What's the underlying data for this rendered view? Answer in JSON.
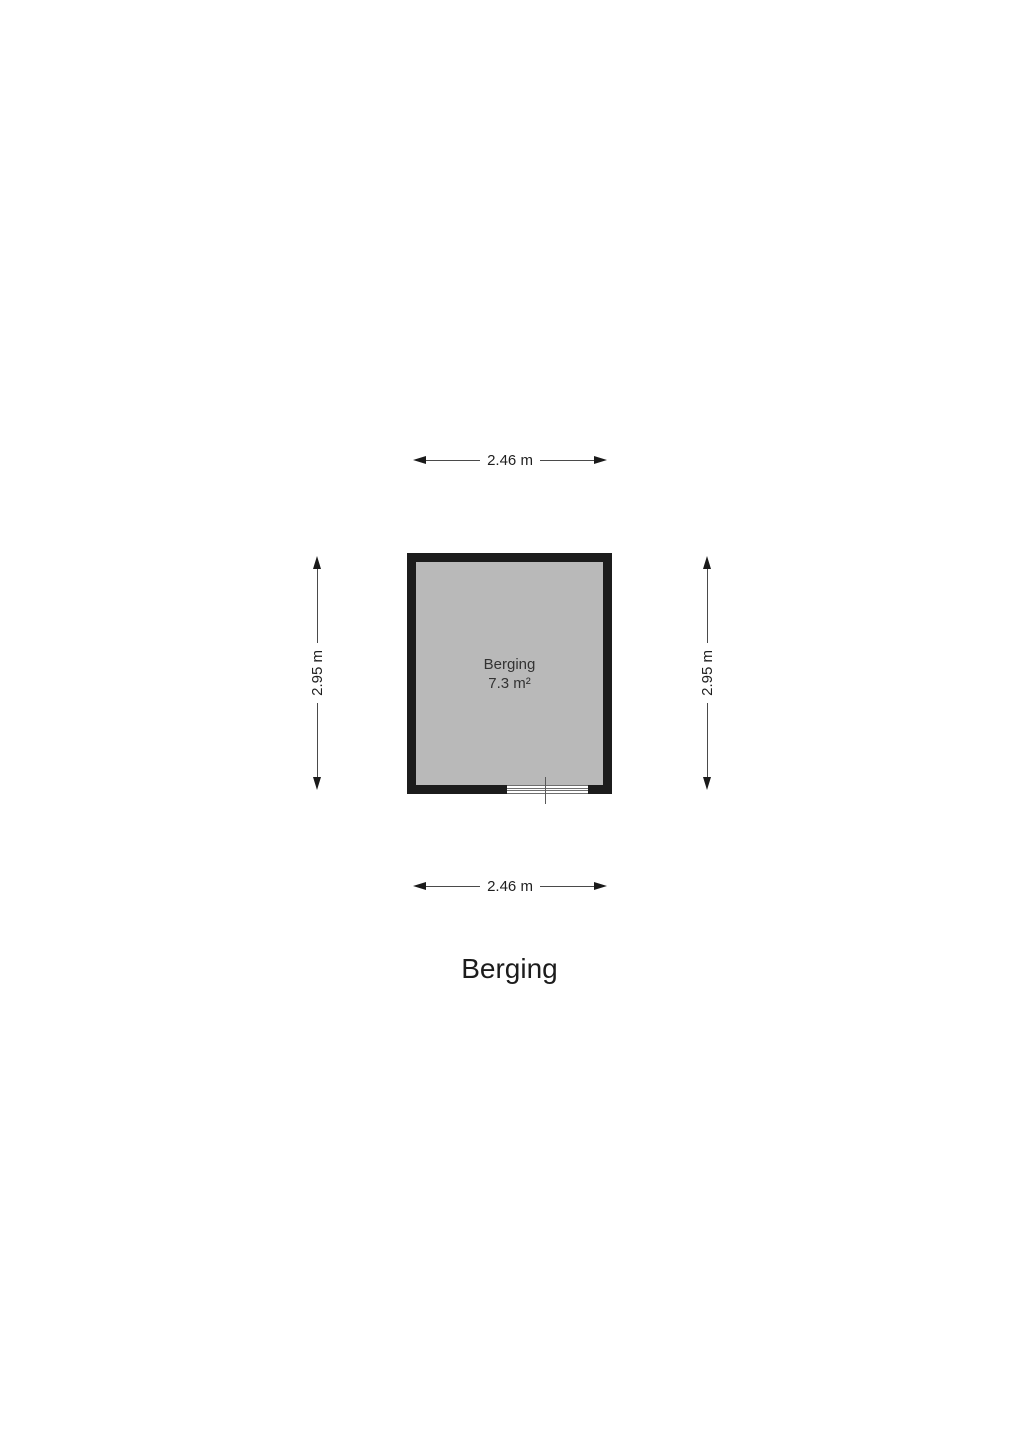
{
  "page": {
    "background": "#ffffff",
    "plan_title": "Berging"
  },
  "floorplan": {
    "room": {
      "name": "Berging",
      "area": "7.3 m²",
      "fill": "#b9b9b9",
      "wall_color": "#1c1c1c"
    },
    "dimensions": {
      "top": "2.46 m",
      "bottom": "2.46 m",
      "left": "2.95 m",
      "right": "2.95 m"
    }
  }
}
